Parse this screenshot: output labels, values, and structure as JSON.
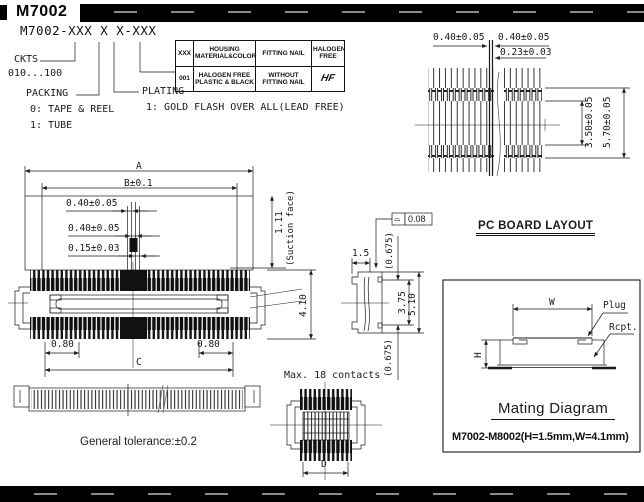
{
  "header": {
    "title": "M7002"
  },
  "part_numbering": {
    "pattern": "M7002-XXX X X-XXX",
    "ckts_label": "CKTS",
    "ckts_range": "010...100",
    "packing_label": "PACKING",
    "packing_options": [
      "0: TAPE & REEL",
      "1: TUBE"
    ],
    "plating_label": "PLATING",
    "plating_option": "1: GOLD FLASH OVER ALL(LEAD FREE)"
  },
  "options_table": {
    "headers": [
      "XXX",
      "HOUSING MATERIAL&COLOR",
      "FITTING NAIL",
      "HALOGEN FREE"
    ],
    "rows": [
      [
        "001",
        "HALOGEN FREE PLASTIC & BLACK",
        "WITHOUT FITTING NAIL",
        "HF"
      ]
    ]
  },
  "pcb_layout": {
    "title": "PC BOARD LAYOUT",
    "dim_pitch_left": "0.40±0.05",
    "dim_pitch_right": "0.40±0.05",
    "dim_key_pad": "0.23±0.03",
    "dim_inner_span": "3.50±0.05",
    "dim_outer_span": "5.70±0.05"
  },
  "front_view": {
    "dim_a": "A",
    "dim_b": "B±0.1",
    "dim_pitch_1": "0.40±0.05",
    "dim_pitch_2": "0.40±0.05",
    "dim_key": "0.15±0.03",
    "dim_suction_h": "1.11",
    "suction_label": "(Suction face)",
    "dim_depth": "4.10",
    "dim_end_left": "0.80",
    "dim_end_right": "0.80",
    "dim_c": "C"
  },
  "side_view": {
    "flatness_symbol": "⌓",
    "flatness_value": "0.08",
    "dim_width": "1.5",
    "dim_top_ref": "(0.675)",
    "dim_mid": "3.75",
    "dim_total": "5.10",
    "dim_bottom_ref": "(0.675)"
  },
  "bottom_view": {
    "note": "Max. 18 contacts",
    "dim_d": "D"
  },
  "notes": {
    "general_tolerance": "General tolerance:±0.2"
  },
  "mating_diagram": {
    "title": "Mating Diagram",
    "dim_w": "W",
    "dim_h": "H",
    "label_plug": "Plug",
    "label_rcpt": "Rcpt.",
    "note": "M7002-M8002(H=1.5mm,W=4.1mm)"
  }
}
